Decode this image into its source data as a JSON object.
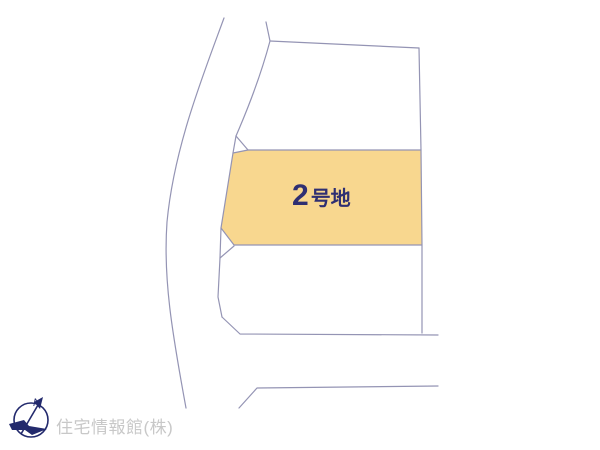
{
  "map": {
    "type": "land-plot-layout",
    "highlighted_plot": {
      "label_full": "2号地",
      "label_number": "2",
      "label_suffix": "号地",
      "fill_color": "#f8d78f",
      "label_color": "#2f2f72"
    },
    "other_plots": [
      "north-plot",
      "south-plot"
    ],
    "line_color": "#9494b4",
    "background_color": "#ffffff"
  },
  "compass": {
    "north_label": "N",
    "color": "#232a6d"
  },
  "footer": {
    "company": "住宅情報館(株)",
    "text_color": "#c8c8c8"
  }
}
